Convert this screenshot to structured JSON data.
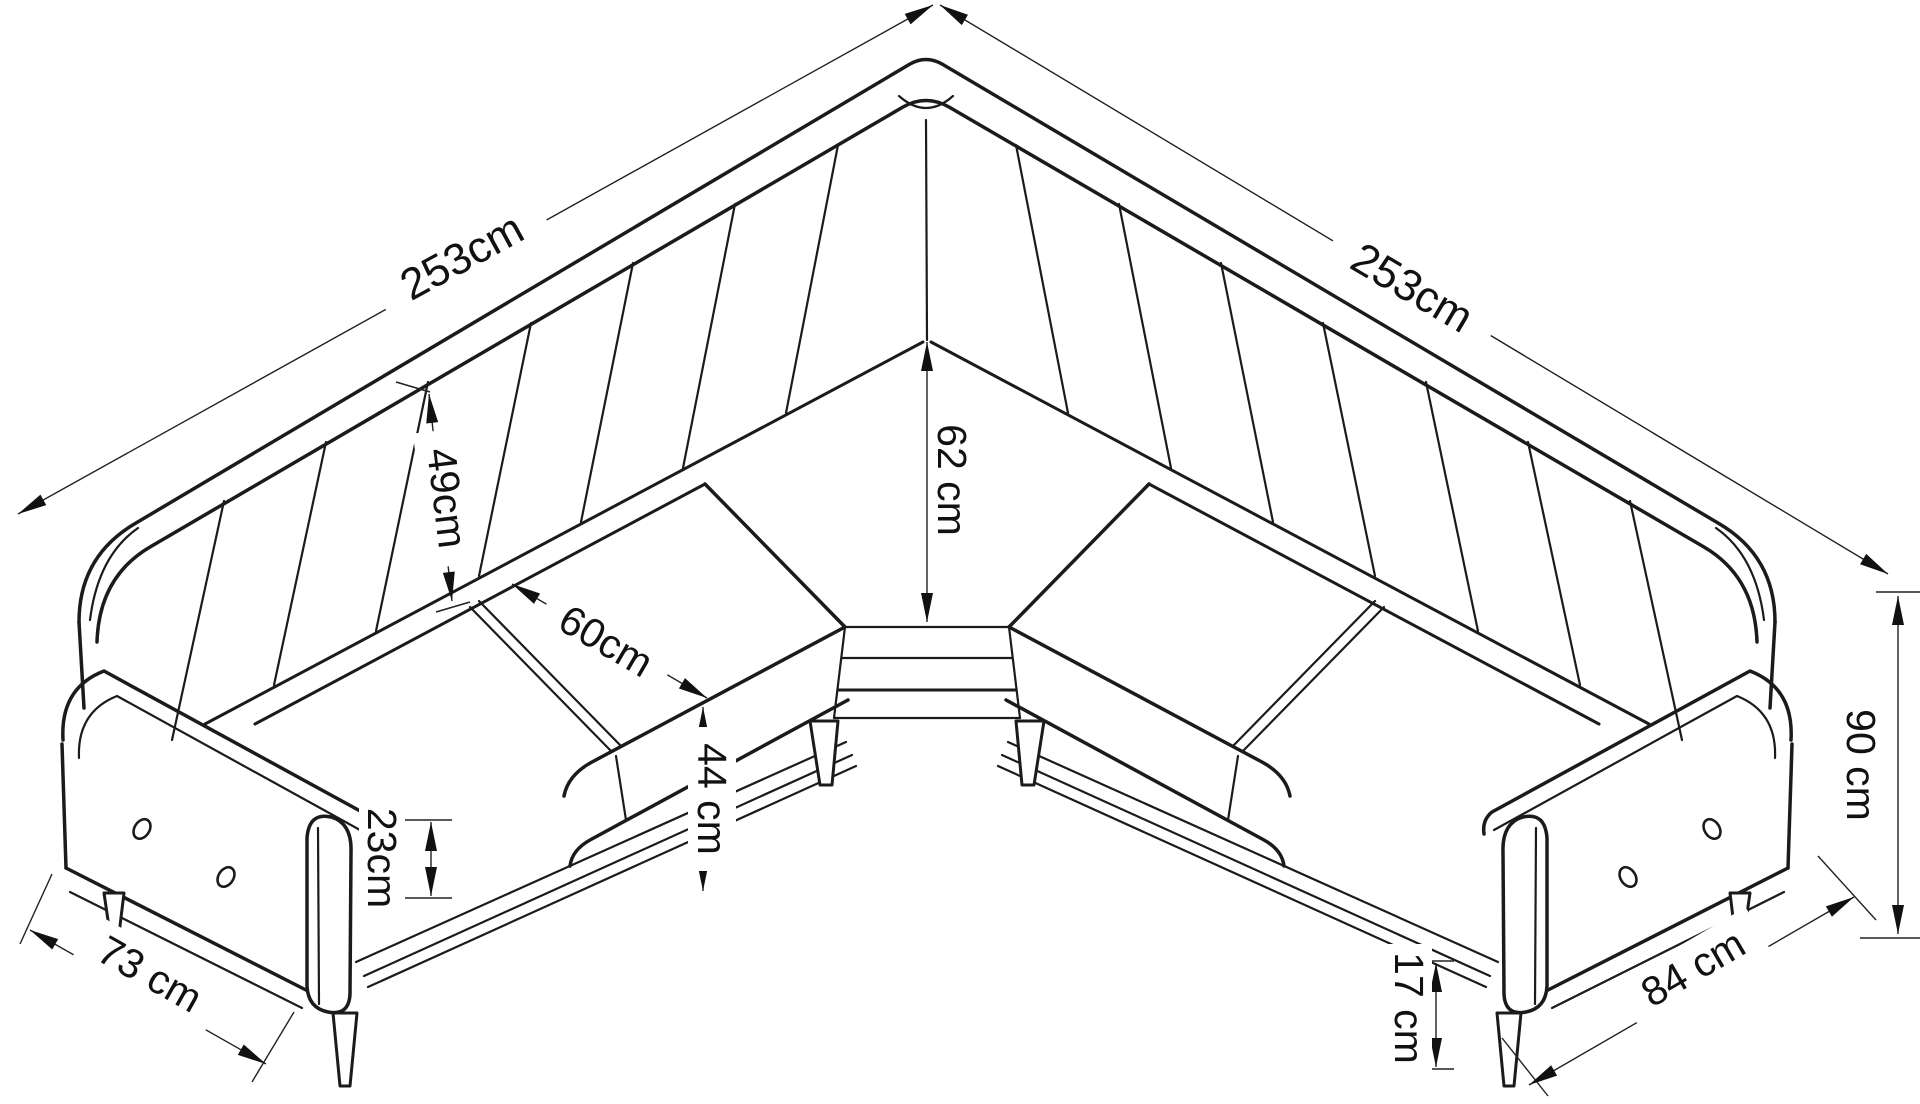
{
  "drawing": {
    "subject": "L-shaped corner sofa technical dimension drawing",
    "line_color": "#1b1b1b",
    "background": "#ffffff",
    "dimensions": {
      "left_side_length": "253cm",
      "right_side_length": "253cm",
      "backrest_height": "49cm",
      "seat_depth": "60cm",
      "corner_seat_depth": "62 cm",
      "seat_height": "44 cm",
      "arm_panel_height": "23cm",
      "left_arm_depth": "73 cm",
      "right_arm_depth": "84 cm",
      "overall_height": "90 cm",
      "leg_height": "17 cm"
    }
  }
}
